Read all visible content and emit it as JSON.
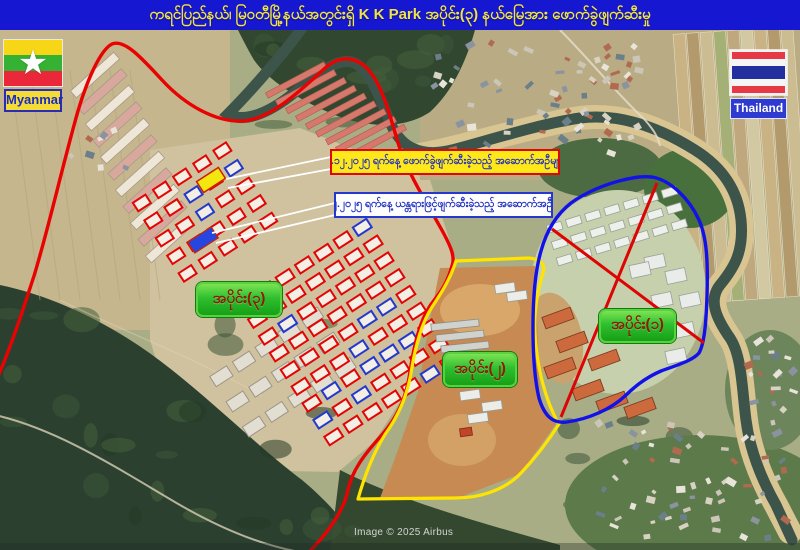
{
  "title_bar": {
    "text": "ကရင်ပြည်နယ်၊ မြဝတီမြို့နယ်အတွင်းရှိ  K K Park အပိုင်း(၃) နယ်မြေအား ဖောက်ခွဲဖျက်ဆီးမှု"
  },
  "flags": {
    "myanmar": {
      "label": "Myanmar"
    },
    "thailand": {
      "label": "Thailand"
    }
  },
  "callouts": {
    "demolished": {
      "text": "၇.၁၂.၂၀၂၅ ရက်နေ့ ဖောက်ခွဲဖျက်ဆီးခဲ့သည့် အဆောက်အဦများ"
    },
    "machinery": {
      "text": "၇.၁၂.၂၀၂၅ ရက်နေ့ ယန္တရားဖြင့်ဖျက်ဆီးခဲ့သည့် အဆောက်အဦးများ"
    }
  },
  "region_labels": {
    "part3": {
      "text": "အပိုင်း(၃)"
    },
    "part2": {
      "text": "အပိုင်း(၂)"
    },
    "part1": {
      "text": "အပိုင်း(၁)"
    }
  },
  "credit": {
    "text": "Image © 2025 Airbus"
  },
  "colors": {
    "title_bg": "#1617d0",
    "title_fg": "#f0e24a",
    "region3_outline": "#e80202",
    "region2_outline": "#ffe400",
    "region1_outline": "#1212e8",
    "region_label_bg": "#2fbf2f",
    "region_label_fg": "#8f1a00",
    "callout1_bg": "#ffe81a",
    "callout1_border": "#e00606",
    "callout2_bg": "#fdfdfd",
    "callout2_border": "#2438cf",
    "highlight_yellow_building": "#f2e70e",
    "highlight_blue_building": "#2746e0",
    "demolished_outline": "#e30505"
  }
}
